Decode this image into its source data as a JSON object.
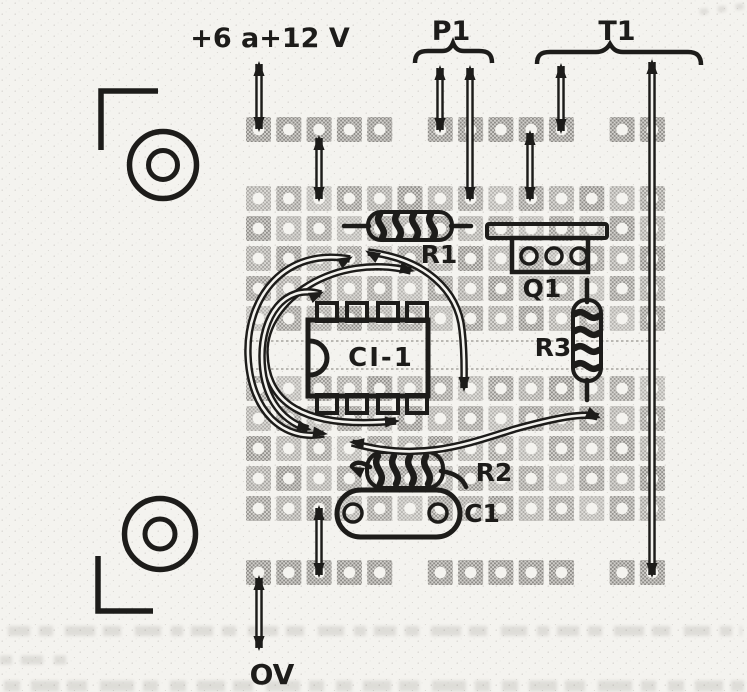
{
  "figure": {
    "kind": "perfboard-component-assembly-diagram",
    "labels": {
      "supply": "+6 a+12 V",
      "p1": "P1",
      "t1": "T1",
      "ov": "OV"
    },
    "components": [
      {
        "ref": "R1",
        "kind": "resistor",
        "orientation": "horizontal"
      },
      {
        "ref": "Q1",
        "kind": "transistor",
        "orientation": "horizontal"
      },
      {
        "ref": "R3",
        "kind": "resistor",
        "orientation": "vertical"
      },
      {
        "ref": "CI-1",
        "kind": "integrated-circuit-dip8",
        "orientation": "horizontal"
      },
      {
        "ref": "R2",
        "kind": "resistor",
        "orientation": "horizontal"
      },
      {
        "ref": "C1",
        "kind": "capacitor",
        "orientation": "horizontal"
      }
    ],
    "board": {
      "columns": 14,
      "pitch": 30.3,
      "pad_size": 25,
      "origin_x": 246,
      "row_groups": [
        {
          "y": 117,
          "rows": 1,
          "row_pitch": 30,
          "missing_cols": [
            5,
            11
          ]
        },
        {
          "y": 186,
          "rows": 5,
          "row_pitch": 30,
          "missing_cols": []
        },
        {
          "y": 376,
          "rows": 5,
          "row_pitch": 30,
          "missing_cols": []
        },
        {
          "y": 560,
          "rows": 1,
          "row_pitch": 30,
          "missing_cols": [
            5,
            11
          ]
        }
      ],
      "channel_lines_y": [
        341,
        369
      ]
    },
    "colors": {
      "ink": "#1d1c1a",
      "paper": "#f4f3ef",
      "pad_base": "#d2d0cc",
      "pad_dot": "#85837f",
      "component_fill": "#faf9f6"
    }
  }
}
